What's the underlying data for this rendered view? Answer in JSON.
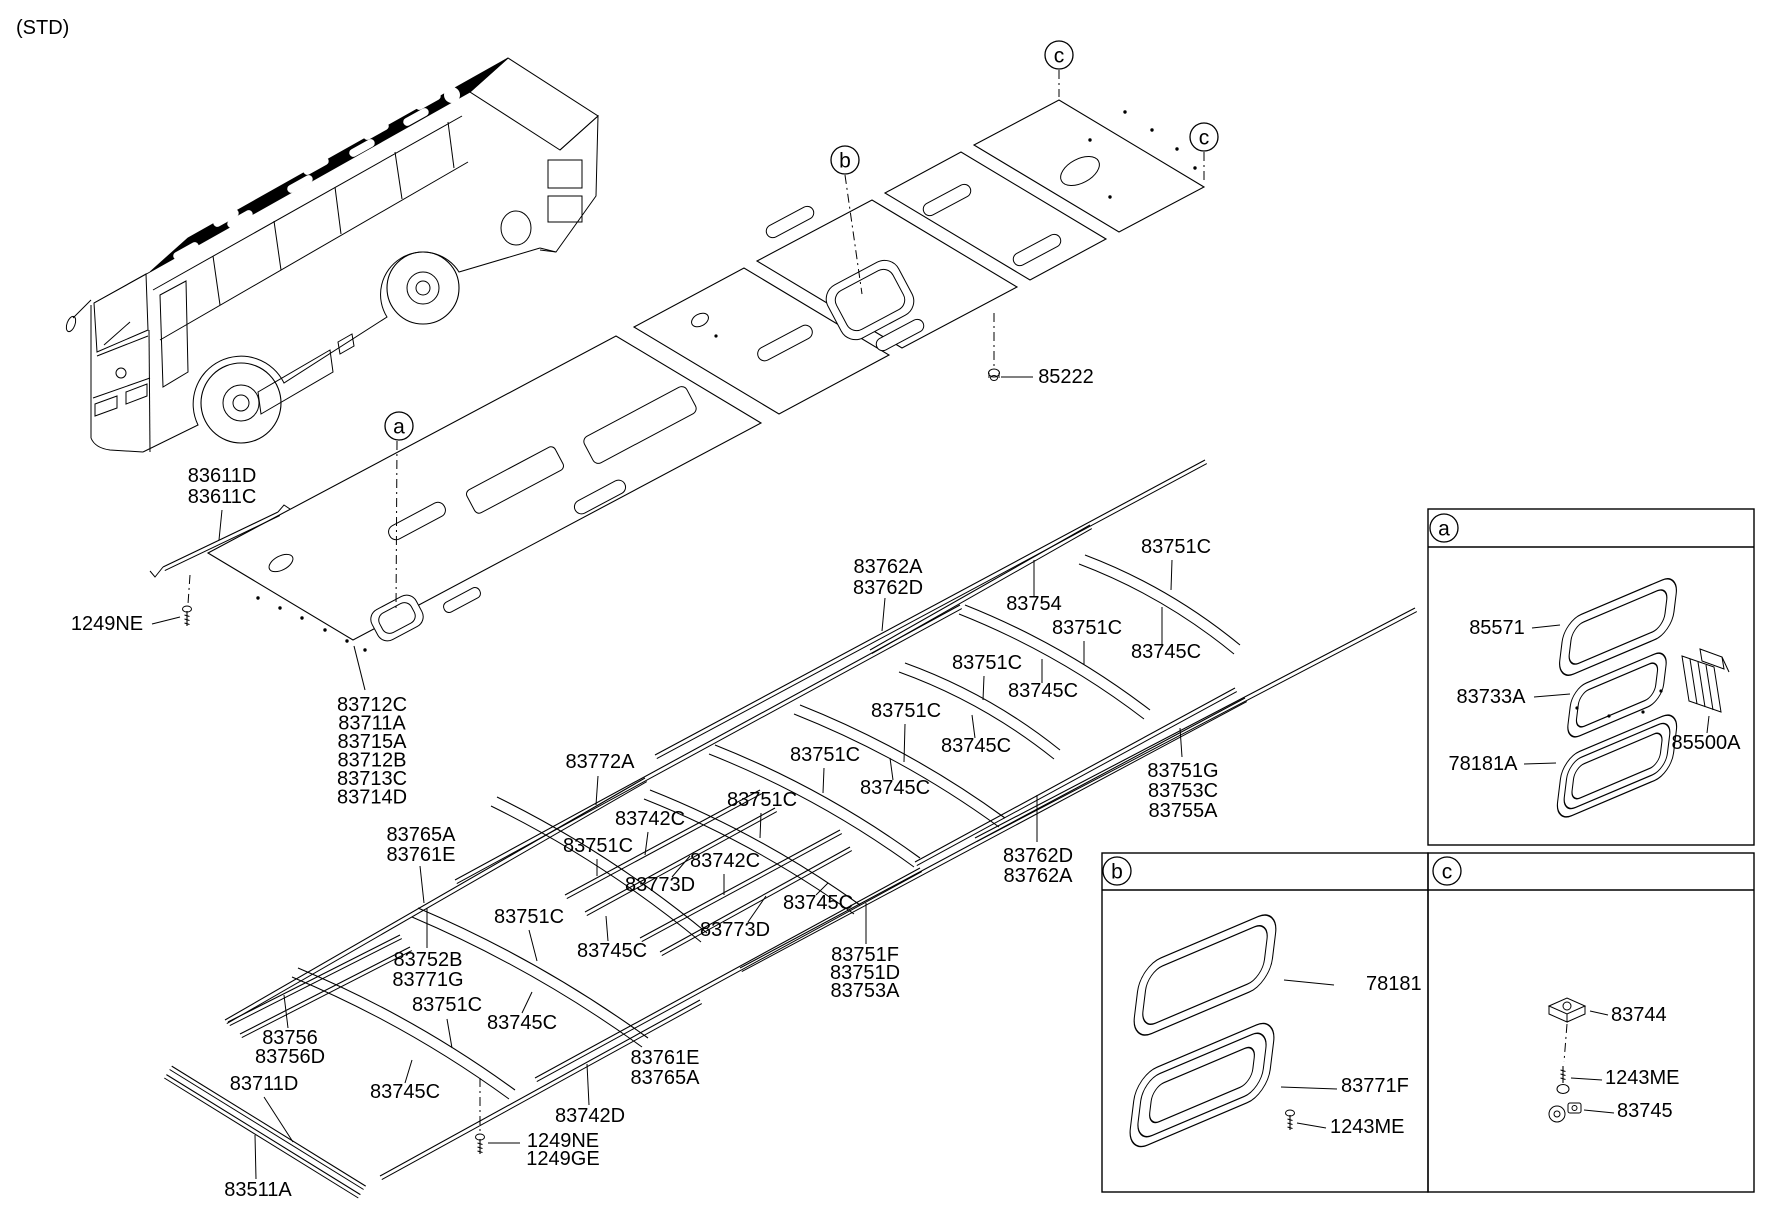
{
  "page": {
    "tag": "(STD)",
    "ink": "#000000",
    "paper": "#ffffff"
  },
  "markers": [
    {
      "name": "callout-a-main",
      "letter": "a",
      "x": 399,
      "y": 426
    },
    {
      "name": "callout-b-main",
      "letter": "b",
      "x": 845,
      "y": 160
    },
    {
      "name": "callout-c-main-1",
      "letter": "c",
      "x": 1059,
      "y": 55
    },
    {
      "name": "callout-c-main-2",
      "letter": "c",
      "x": 1204,
      "y": 137
    },
    {
      "name": "inset-a-letter",
      "letter": "a",
      "x": 1444,
      "y": 528
    },
    {
      "name": "inset-b-letter",
      "letter": "b",
      "x": 1117,
      "y": 871
    },
    {
      "name": "inset-c-letter",
      "letter": "c",
      "x": 1447,
      "y": 871
    }
  ],
  "labels": [
    {
      "name": "std-tag",
      "text": "(STD)",
      "x": 16,
      "y": 34,
      "anchor": "start",
      "size": 22
    },
    {
      "name": "83611",
      "lines": [
        "83611D",
        "83611C"
      ],
      "x": 222,
      "y": 482,
      "lh": 21
    },
    {
      "name": "1249NE-left",
      "text": "1249NE",
      "x": 107,
      "y": 630
    },
    {
      "name": "83712-group",
      "lines": [
        "83712C",
        "83711A",
        "83715A",
        "83712B",
        "83713C",
        "83714D"
      ],
      "x": 372,
      "y": 711,
      "lh": 18.5
    },
    {
      "name": "83772A",
      "text": "83772A",
      "x": 600,
      "y": 768
    },
    {
      "name": "83742C-1",
      "text": "83742C",
      "x": 650,
      "y": 825
    },
    {
      "name": "83751C-c7",
      "text": "83751C",
      "x": 598,
      "y": 852
    },
    {
      "name": "83742C-2",
      "text": "83742C",
      "x": 725,
      "y": 867
    },
    {
      "name": "83773D-1",
      "text": "83773D",
      "x": 660,
      "y": 891
    },
    {
      "name": "83745C-c6",
      "text": "83745C",
      "x": 818,
      "y": 909
    },
    {
      "name": "83773D-2",
      "text": "83773D",
      "x": 735,
      "y": 936
    },
    {
      "name": "83745C-c7",
      "text": "83745C",
      "x": 612,
      "y": 957
    },
    {
      "name": "83751C-c6",
      "text": "83751C",
      "x": 762,
      "y": 806
    },
    {
      "name": "83751C-c5",
      "text": "83751C",
      "x": 825,
      "y": 761
    },
    {
      "name": "83745C-c5",
      "text": "83745C",
      "x": 895,
      "y": 794
    },
    {
      "name": "83751C-c4",
      "text": "83751C",
      "x": 906,
      "y": 717
    },
    {
      "name": "83745C-c4",
      "text": "83745C",
      "x": 976,
      "y": 752
    },
    {
      "name": "83751C-c3",
      "text": "83751C",
      "x": 987,
      "y": 669
    },
    {
      "name": "83745C-c3",
      "text": "83745C",
      "x": 1043,
      "y": 697
    },
    {
      "name": "83751C-c2",
      "text": "83751C",
      "x": 1087,
      "y": 634
    },
    {
      "name": "83745C-c2",
      "text": "83745C",
      "x": 1166,
      "y": 658
    },
    {
      "name": "83751C-c1",
      "text": "83751C",
      "x": 1176,
      "y": 553
    },
    {
      "name": "83754",
      "text": "83754",
      "x": 1034,
      "y": 610
    },
    {
      "name": "83762-upper",
      "lines": [
        "83762A",
        "83762D"
      ],
      "x": 888,
      "y": 573,
      "lh": 21
    },
    {
      "name": "83751G-group",
      "lines": [
        "83751G",
        "83753C",
        "83755A"
      ],
      "x": 1183,
      "y": 777,
      "lh": 20
    },
    {
      "name": "83762-right",
      "lines": [
        "83762D",
        "83762A"
      ],
      "x": 1038,
      "y": 862,
      "lh": 20
    },
    {
      "name": "83751F-group",
      "lines": [
        "83751F",
        "83751D",
        "83753A"
      ],
      "x": 865,
      "y": 961,
      "lh": 18
    },
    {
      "name": "83765A-upper",
      "lines": [
        "83765A",
        "83761E"
      ],
      "x": 421,
      "y": 841,
      "lh": 20
    },
    {
      "name": "83752B-group",
      "lines": [
        "83752B",
        "83771G"
      ],
      "x": 428,
      "y": 966,
      "lh": 20
    },
    {
      "name": "83751C-bowY",
      "text": "83751C",
      "x": 529,
      "y": 923
    },
    {
      "name": "83745C-bowY",
      "text": "83745C",
      "x": 522,
      "y": 1029
    },
    {
      "name": "83751C-bowX",
      "text": "83751C",
      "x": 447,
      "y": 1011
    },
    {
      "name": "83745C-bowX",
      "text": "83745C",
      "x": 405,
      "y": 1098
    },
    {
      "name": "83756-group",
      "lines": [
        "83756",
        "83756D"
      ],
      "x": 290,
      "y": 1044,
      "lh": 19
    },
    {
      "name": "83711D",
      "text": "83711D",
      "x": 264,
      "y": 1090
    },
    {
      "name": "83511A",
      "text": "83511A",
      "x": 258,
      "y": 1196
    },
    {
      "name": "83742D",
      "text": "83742D",
      "x": 590,
      "y": 1122
    },
    {
      "name": "1249-bottom",
      "lines": [
        "1249NE",
        "1249GE"
      ],
      "x": 563,
      "y": 1147,
      "lh": 18
    },
    {
      "name": "83761E-bottom",
      "lines": [
        "83761E",
        "83765A"
      ],
      "x": 665,
      "y": 1064,
      "lh": 20
    },
    {
      "name": "85222",
      "text": "85222",
      "x": 1066,
      "y": 383
    },
    {
      "name": "85571",
      "text": "85571",
      "x": 1497,
      "y": 634
    },
    {
      "name": "83733A",
      "text": "83733A",
      "x": 1491,
      "y": 703
    },
    {
      "name": "78181A",
      "text": "78181A",
      "x": 1483,
      "y": 770
    },
    {
      "name": "85500A",
      "text": "85500A",
      "x": 1706,
      "y": 749
    },
    {
      "name": "78181-b",
      "text": "78181",
      "x": 1366,
      "y": 990,
      "anchor": "start",
      "x2": 1337
    },
    {
      "name": "83771F",
      "text": "83771F",
      "x": 1341,
      "y": 1092,
      "anchor": "start"
    },
    {
      "name": "1243ME-b",
      "text": "1243ME",
      "x": 1330,
      "y": 1133,
      "anchor": "start"
    },
    {
      "name": "83744",
      "text": "83744",
      "x": 1611,
      "y": 1021,
      "anchor": "start"
    },
    {
      "name": "1243ME-c",
      "text": "1243ME",
      "x": 1605,
      "y": 1084,
      "anchor": "start"
    },
    {
      "name": "83745-c",
      "text": "83745",
      "x": 1617,
      "y": 1117,
      "anchor": "start"
    }
  ]
}
